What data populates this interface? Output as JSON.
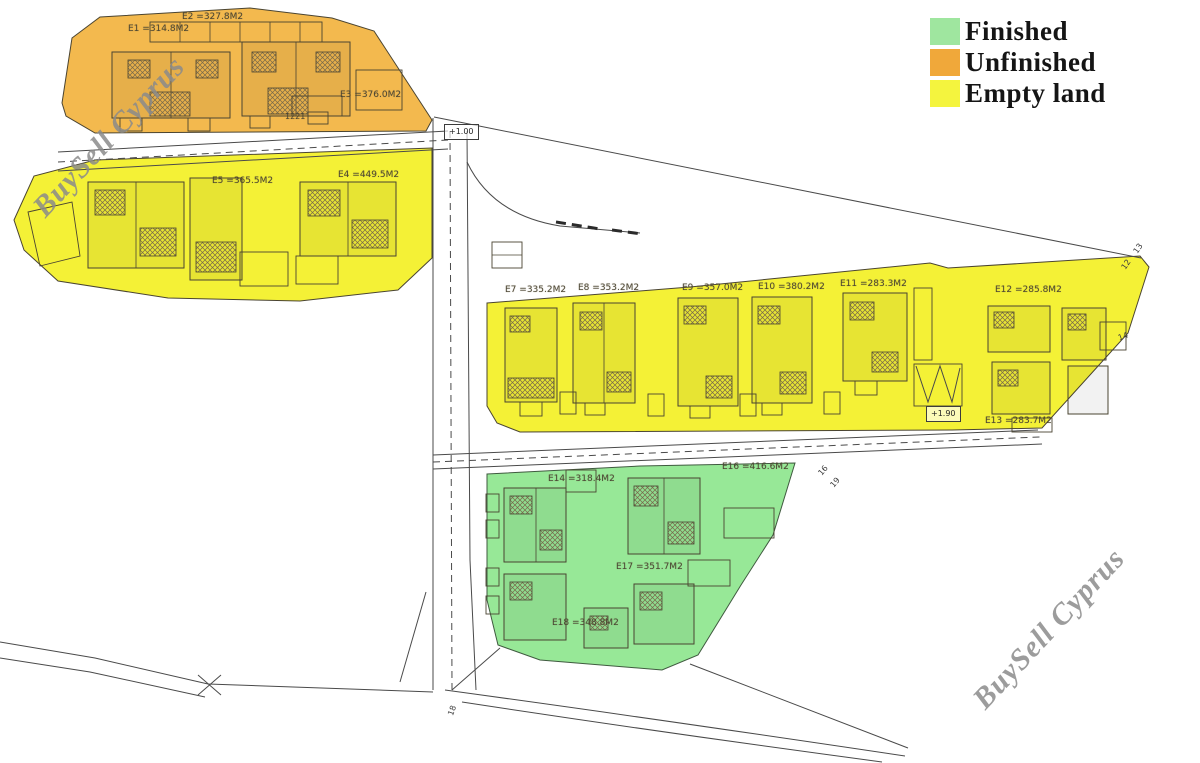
{
  "legend": {
    "items": [
      {
        "label": "Finished",
        "color": "#9fe69f"
      },
      {
        "label": "Unfinished",
        "color": "#f0a83a"
      },
      {
        "label": "Empty land",
        "color": "#f4f43e"
      }
    ]
  },
  "watermarks": [
    {
      "text": "BuySell Cyprus"
    },
    {
      "text": "BuySell Cyprus"
    }
  ],
  "plots": [
    {
      "label": "E1 =314.8M2"
    },
    {
      "label": "E2 =327.8M2"
    },
    {
      "label": "E3 =376.0M2"
    },
    {
      "label": "E5 =365.5M2"
    },
    {
      "label": "E4 =449.5M2"
    },
    {
      "label": "E7 =335.2M2"
    },
    {
      "label": "E8 =353.2M2"
    },
    {
      "label": "E9 =357.0M2"
    },
    {
      "label": "E10 =380.2M2"
    },
    {
      "label": "E11 =283.3M2"
    },
    {
      "label": "E12 =285.8M2"
    },
    {
      "label": "E13 =283.7M2"
    },
    {
      "label": "E14 =318.4M2"
    },
    {
      "label": "E16 =416.6M2"
    },
    {
      "label": "E17 =351.7M2"
    },
    {
      "label": "E18 =348.8M2"
    },
    {
      "label": "1221"
    }
  ],
  "annotations": {
    "elevation_top": "+1.00",
    "elevation_mid": "+1.90",
    "corner_numbers": [
      "13",
      "12",
      "14",
      "16",
      "19",
      "18"
    ]
  },
  "region_status": [
    {
      "area": "north-west-block",
      "status": "Unfinished"
    },
    {
      "area": "west-block",
      "status": "Empty land"
    },
    {
      "area": "central-east-block",
      "status": "Empty land"
    },
    {
      "area": "south-block",
      "status": "Finished"
    }
  ]
}
